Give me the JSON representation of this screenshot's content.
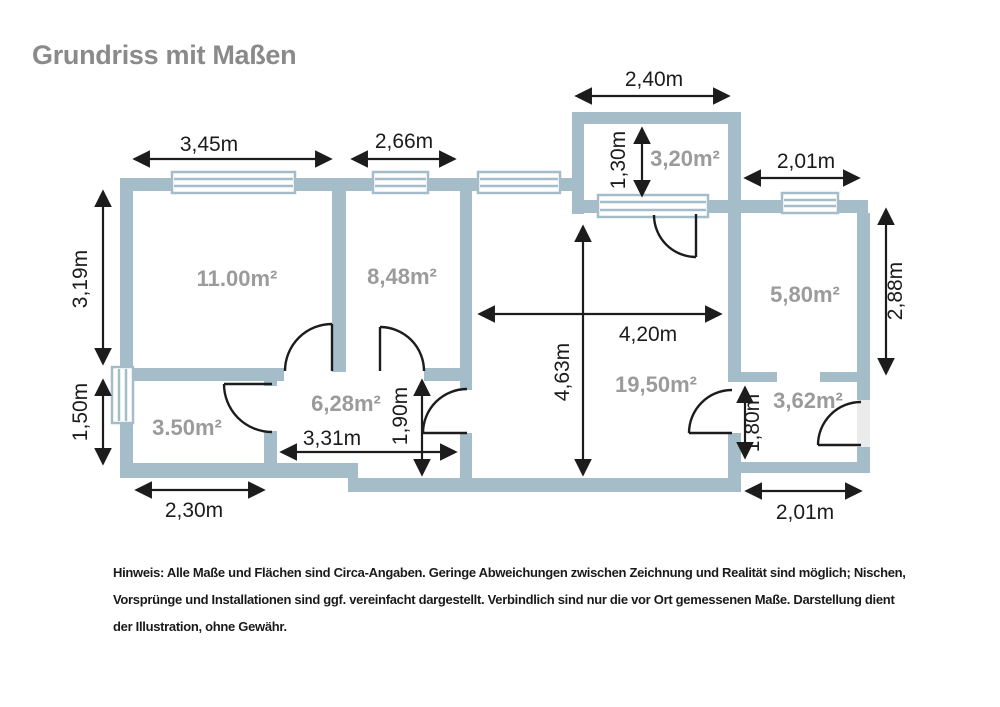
{
  "title": "Grundriss mit Maßen",
  "colors": {
    "wall": "#a5bdc8",
    "lines_and_text": "#1c1c1c",
    "area_label": "#9b9b9b",
    "title": "#8a8a8a",
    "door_opening": "#ebebeb",
    "background": "#ffffff"
  },
  "rooms": [
    {
      "name": "room-top-left",
      "area": "11.00m²"
    },
    {
      "name": "room-top-middle",
      "area": "8,48m²"
    },
    {
      "name": "balcony",
      "area": "3,20m²"
    },
    {
      "name": "room-top-right",
      "area": "5,80m²"
    },
    {
      "name": "living-room",
      "area": "19,50m²"
    },
    {
      "name": "hallway",
      "area": "6,28m²"
    },
    {
      "name": "room-bottom-left",
      "area": "3.50m²"
    },
    {
      "name": "vestibule",
      "area": "3,62m²"
    }
  ],
  "dimensions": [
    {
      "name": "width-room-top-left",
      "value": "3,45m"
    },
    {
      "name": "width-room-top-middle",
      "value": "2,66m"
    },
    {
      "name": "width-balcony",
      "value": "2,40m"
    },
    {
      "name": "width-room-top-right",
      "value": "2,01m"
    },
    {
      "name": "height-room-top-left",
      "value": "3,19m"
    },
    {
      "name": "height-room-bottom-left",
      "value": "1,50m"
    },
    {
      "name": "depth-balcony",
      "value": "1,30m"
    },
    {
      "name": "height-room-top-right",
      "value": "2,88m"
    },
    {
      "name": "width-living-room",
      "value": "4,20m"
    },
    {
      "name": "height-living-room",
      "value": "4,63m"
    },
    {
      "name": "width-hallway",
      "value": "3,31m"
    },
    {
      "name": "depth-hallway",
      "value": "1,90m"
    },
    {
      "name": "opening-vestibule",
      "value": "1,80m"
    },
    {
      "name": "width-bottom-left",
      "value": "2,30m"
    },
    {
      "name": "width-bottom-right",
      "value": "2,01m"
    }
  ],
  "note": [
    "Hinweis: Alle Maße und Flächen sind Circa-Angaben. Geringe Abweichungen zwischen Zeichnung und Realität sind möglich; Nischen,",
    "Vorsprünge und Installationen sind ggf. vereinfacht dargestellt. Verbindlich sind nur die vor Ort gemessenen Maße. Darstellung dient",
    "der Illustration, ohne Gewähr."
  ]
}
